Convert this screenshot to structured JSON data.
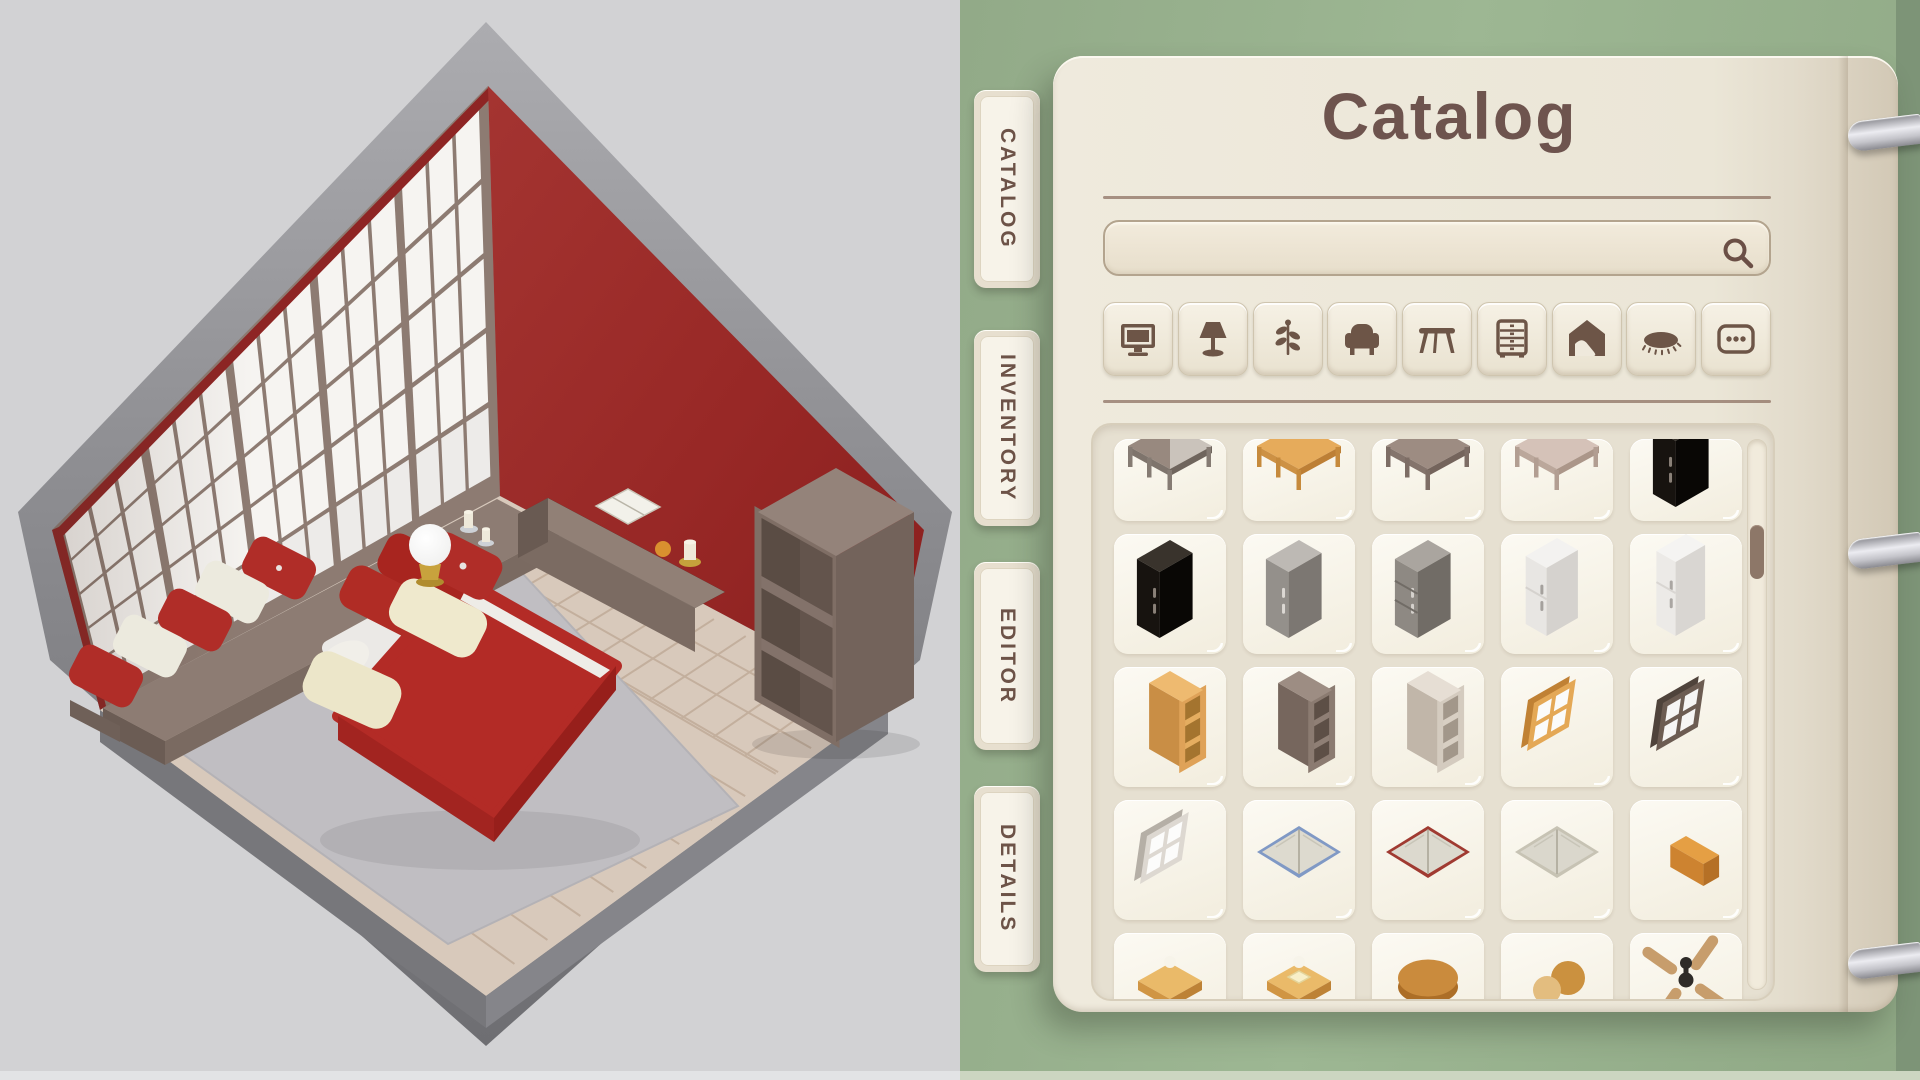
{
  "scene": {
    "type": "isometric-room-preview",
    "objects": [
      {
        "name": "shoji-screen-wall",
        "color": "#8d7b72"
      },
      {
        "name": "red-accent-wall",
        "color": "#9c2b29"
      },
      {
        "name": "wood-plank-floor",
        "color": "#d8c9bb"
      },
      {
        "name": "gray-area-rug",
        "color": "#c0bec2"
      },
      {
        "name": "engawa-platform",
        "color": "#8d7c73"
      },
      {
        "name": "floor-cushion-red-button",
        "color": "#b02d28"
      },
      {
        "name": "floor-cushion-white",
        "color": "#eceade"
      },
      {
        "name": "floor-cushion-red",
        "color": "#b02d28"
      },
      {
        "name": "floor-cushion-white-2",
        "color": "#eceade"
      },
      {
        "name": "floor-cushion-red-2",
        "color": "#b02d28"
      },
      {
        "name": "sphere-lamp",
        "color": "#ffffff",
        "base": "#c8a23d"
      },
      {
        "name": "candles",
        "color": "#efe9d8"
      },
      {
        "name": "double-bed",
        "duvet": "#b32b26",
        "mattress": "#ebe9e6"
      },
      {
        "name": "bed-pillow-red",
        "color": "#a8251f"
      },
      {
        "name": "bed-pillow-red-2",
        "color": "#a8251f"
      },
      {
        "name": "bed-pillow-cream",
        "color": "#efe9cd"
      },
      {
        "name": "throw-pillow-on-rug",
        "color": "#ece6c9"
      },
      {
        "name": "button-cushion-on-rug",
        "color": "#b02d28"
      },
      {
        "name": "low-bench",
        "color": "#84736b"
      },
      {
        "name": "open-book-on-bench",
        "color": "#f2f1ea"
      },
      {
        "name": "orange-fruit",
        "color": "#d9902f"
      },
      {
        "name": "bench-candle",
        "color": "#efe9d8"
      },
      {
        "name": "open-bookshelf",
        "color": "#73635b"
      }
    ],
    "palette": {
      "background": "#d2d2d4",
      "outer_slab": "#8d8d91"
    }
  },
  "panel": {
    "title": "Catalog",
    "tabs": [
      {
        "label": "CATALOG",
        "active": true
      },
      {
        "label": "INVENTORY",
        "active": false
      },
      {
        "label": "EDITOR",
        "active": false
      },
      {
        "label": "DETAILS",
        "active": false
      }
    ],
    "search": {
      "value": "",
      "placeholder": ""
    },
    "categories": [
      {
        "name": "screens",
        "icon": "tv"
      },
      {
        "name": "lighting",
        "icon": "lamp"
      },
      {
        "name": "plants",
        "icon": "plant"
      },
      {
        "name": "seating",
        "icon": "armchair"
      },
      {
        "name": "tables",
        "icon": "table"
      },
      {
        "name": "storage",
        "icon": "dresser"
      },
      {
        "name": "wall-decor",
        "icon": "house"
      },
      {
        "name": "rugs",
        "icon": "rug"
      },
      {
        "name": "more",
        "icon": "dots"
      }
    ],
    "items": [
      {
        "name": "corner-desk-two-tone",
        "icon": "desk",
        "c": {
          "top": "#98897f",
          "top2": "#cac3bb",
          "side": "#7e746c",
          "side2": "#6f655d",
          "leg": "#857b73"
        }
      },
      {
        "name": "table-light-wood",
        "icon": "table",
        "c": {
          "top": "#e6ab5b",
          "side": "#cd9144",
          "side2": "#bd7f35",
          "leg": "#c68a3c"
        }
      },
      {
        "name": "table-taupe",
        "icon": "table",
        "c": {
          "top": "#9d8c82",
          "side": "#84746c",
          "side2": "#74645c",
          "leg": "#7d6d65"
        }
      },
      {
        "name": "table-pale-wood",
        "icon": "table",
        "c": {
          "top": "#d5c2b8",
          "side": "#bba79b",
          "side2": "#ab9689",
          "leg": "#b29e92"
        }
      },
      {
        "name": "wardrobe-black-peek",
        "icon": "wardrobe",
        "c": {
          "top": "#39332c",
          "front": "#17130f",
          "side": "#090705",
          "handle": "#8a8178"
        }
      },
      {
        "name": "wardrobe-black",
        "icon": "wardrobe",
        "c": {
          "top": "#39332c",
          "front": "#17130f",
          "side": "#090705",
          "handle": "#8a8178"
        }
      },
      {
        "name": "wardrobe-gray",
        "icon": "wardrobe",
        "c": {
          "top": "#bdb9b4",
          "front": "#94908b",
          "side": "#7c7772",
          "handle": "#dcd8d3"
        }
      },
      {
        "name": "cabinet-gray-drawers",
        "icon": "cabinet",
        "c": {
          "top": "#aaa59f",
          "front": "#8e8983",
          "side": "#716c66",
          "handle": "#d5d1cc"
        }
      },
      {
        "name": "refrigerator-white",
        "icon": "fridge",
        "c": {
          "top": "#f3f2f0",
          "front": "#e8e6e3",
          "side": "#d5d2ce",
          "handle": "#a5a19d"
        }
      },
      {
        "name": "refrigerator-white-tall",
        "icon": "fridge2",
        "c": {
          "top": "#f5f4f2",
          "front": "#eceae7",
          "side": "#d9d6d2",
          "handle": "#aaa6a2"
        }
      },
      {
        "name": "bookshelf-light-wood",
        "icon": "shelf",
        "c": {
          "top": "#eeba70",
          "side": "#c98e45",
          "interior": "#a4742f",
          "shelf": "#e5ad60",
          "frame": "#dfa258"
        }
      },
      {
        "name": "bookshelf-taupe",
        "icon": "shelf",
        "c": {
          "top": "#9d8d83",
          "side": "#76665d",
          "interior": "#5d4f46",
          "shelf": "#8f7f75",
          "frame": "#8b7b71"
        }
      },
      {
        "name": "bookshelf-beige",
        "icon": "shelf",
        "c": {
          "top": "#e6ded4",
          "side": "#c1b6a9",
          "interior": "#a2978a",
          "shelf": "#d8cfc3",
          "frame": "#d4cbbf"
        }
      },
      {
        "name": "window-light-wood",
        "icon": "window",
        "c": {
          "frame": "#e4a856",
          "edge": "#c08134",
          "pane": "#fbfbfa"
        }
      },
      {
        "name": "window-dark-brown",
        "icon": "window",
        "c": {
          "frame": "#6c5c52",
          "edge": "#4f433b",
          "pane": "#f6f5f4"
        }
      },
      {
        "name": "window-white",
        "icon": "window",
        "c": {
          "frame": "#ddd8d1",
          "edge": "#b5afa6",
          "pane": "#fcfcfb"
        }
      },
      {
        "name": "open-book-blue-cover",
        "icon": "book",
        "c": {
          "cover": "#8099c5",
          "pages": "#dddacf"
        }
      },
      {
        "name": "open-book-red-cover",
        "icon": "book",
        "c": {
          "cover": "#a03a31",
          "pages": "#dcd9ce"
        }
      },
      {
        "name": "open-book-plain",
        "icon": "book",
        "c": {
          "cover": "#c7c3b4",
          "pages": "#dad7cc"
        }
      },
      {
        "name": "bread-loaf",
        "icon": "loaf",
        "c": {
          "top": "#e59f44",
          "front": "#cd8330",
          "side": "#b57026"
        }
      },
      {
        "name": "toast-slice",
        "icon": "toast",
        "c": {
          "top": "#eaba69",
          "crust": "#d09543",
          "crust2": "#bd8236"
        }
      },
      {
        "name": "toast-with-butter",
        "icon": "toast",
        "c": {
          "top": "#eaba69",
          "crust": "#d09543",
          "crust2": "#bd8236",
          "butter": "#f8efc8"
        }
      },
      {
        "name": "pancake-bun",
        "icon": "bun",
        "c": {
          "top": "#ca8b3d",
          "base": "#ac6e27"
        }
      },
      {
        "name": "cookies",
        "icon": "cookies",
        "c": {
          "a": "#cb913f",
          "b": "#e3bd7f"
        }
      },
      {
        "name": "ceiling-fan",
        "icon": "fan",
        "c": {
          "blade": "#c79d6c",
          "hub": "#2e2b28"
        }
      }
    ],
    "grid": {
      "columns": 5,
      "visible_rows": 5,
      "scrollbar": {
        "orientation": "vertical",
        "thumb_fraction_from_top": 0.15
      }
    },
    "colors": {
      "bg_green": "#9db793",
      "panel_cream": "#ece7d8",
      "accent_brown": "#6e544e",
      "icon_brown": "#6d5547",
      "card_bg": "#f8f5ec",
      "scroll_thumb": "#8d7768",
      "metal": "#c9c9cf",
      "rule": "#8d7163"
    }
  }
}
